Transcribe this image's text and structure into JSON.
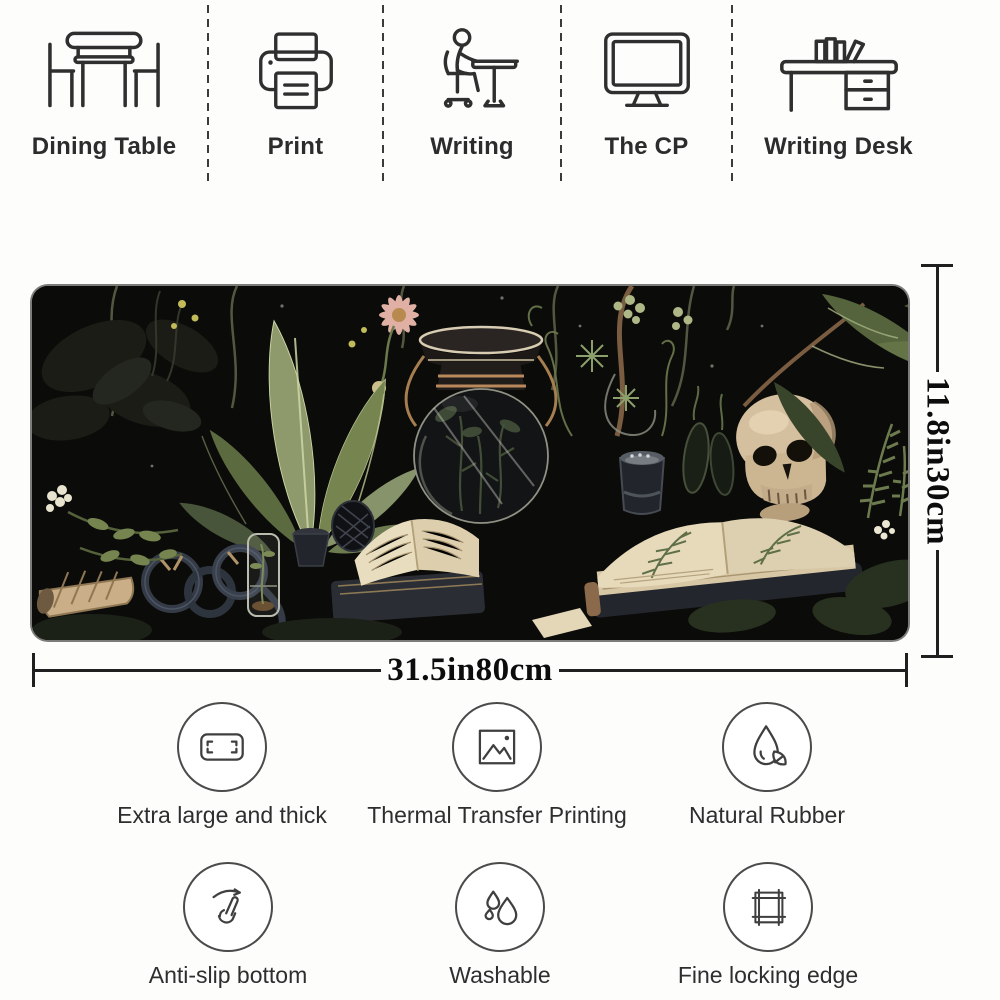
{
  "use_cases": {
    "items": [
      {
        "label": "Dining Table",
        "icon": "dining-table-icon"
      },
      {
        "label": "Print",
        "icon": "printer-icon"
      },
      {
        "label": "Writing",
        "icon": "writing-person-icon"
      },
      {
        "label": "The CP",
        "icon": "computer-monitor-icon"
      },
      {
        "label": "Writing Desk",
        "icon": "writing-desk-icon"
      }
    ]
  },
  "dimensions": {
    "width_label": "31.5in80cm",
    "height_label": "11.8in30cm"
  },
  "features": {
    "row1": [
      {
        "label": "Extra large and thick",
        "icon": "mat-size-icon"
      },
      {
        "label": "Thermal Transfer Printing",
        "icon": "image-print-icon"
      },
      {
        "label": "Natural Rubber",
        "icon": "rubber-drop-leaf-icon"
      }
    ],
    "row2": [
      {
        "label": "Anti-slip bottom",
        "icon": "hand-swipe-icon"
      },
      {
        "label": "Washable",
        "icon": "water-drops-icon"
      },
      {
        "label": "Fine locking edge",
        "icon": "locking-edge-icon"
      }
    ]
  },
  "artwork": {
    "description": "Dark botanical still-life desk mat: sage leaves, glass apothecary jar, skull, herbarium books, shell, rope coils and ferns on black",
    "colors": {
      "mat_background": "#0b0b09",
      "leaf_green": "#7f8c58",
      "leaf_dark": "#3c472c",
      "book_cream": "#e2d4b4",
      "bone": "#d4bf9f",
      "copper": "#b9895c",
      "flower_pink": "#e0b0a4",
      "dimension_line": "#1f1f1f"
    }
  }
}
